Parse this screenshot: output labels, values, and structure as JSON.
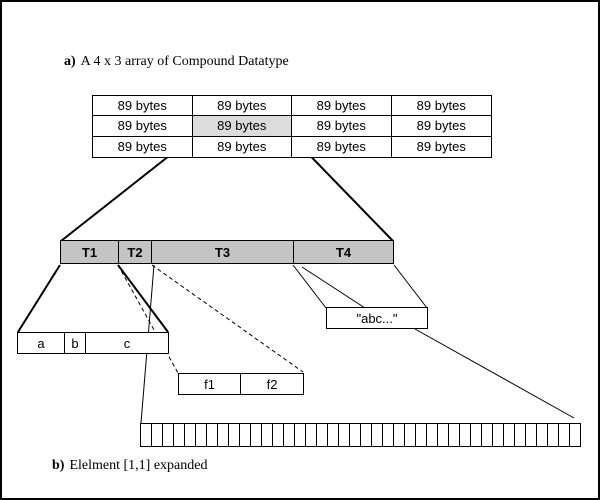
{
  "panel_a": {
    "label_prefix": "a)",
    "label_text": "A 4 x 3 array of Compound Datatype",
    "array_table": {
      "rows": 3,
      "cols": 4,
      "cell_label": "89 bytes",
      "highlighted_cell": {
        "row": 2,
        "col": 2
      }
    }
  },
  "panel_b": {
    "label_prefix": "b)",
    "label_text": "Elelment [1,1] expanded",
    "compound_bar": {
      "segments": [
        {
          "label": "T1"
        },
        {
          "label": "T2"
        },
        {
          "label": "T3"
        },
        {
          "label": "T4"
        }
      ]
    },
    "t1_fields": [
      {
        "label": "a"
      },
      {
        "label": "b"
      },
      {
        "label": "c"
      }
    ],
    "t2_fields": [
      {
        "label": "f1"
      },
      {
        "label": "f2"
      }
    ],
    "t4_string_value": "\"abc...\"",
    "byte_bar": {
      "cell_count": 40
    }
  },
  "colors": {
    "background": "#ffffff",
    "bar_fill": "#c4c4c4",
    "highlight_fill": "#dcdcdc",
    "line": "#000000"
  }
}
